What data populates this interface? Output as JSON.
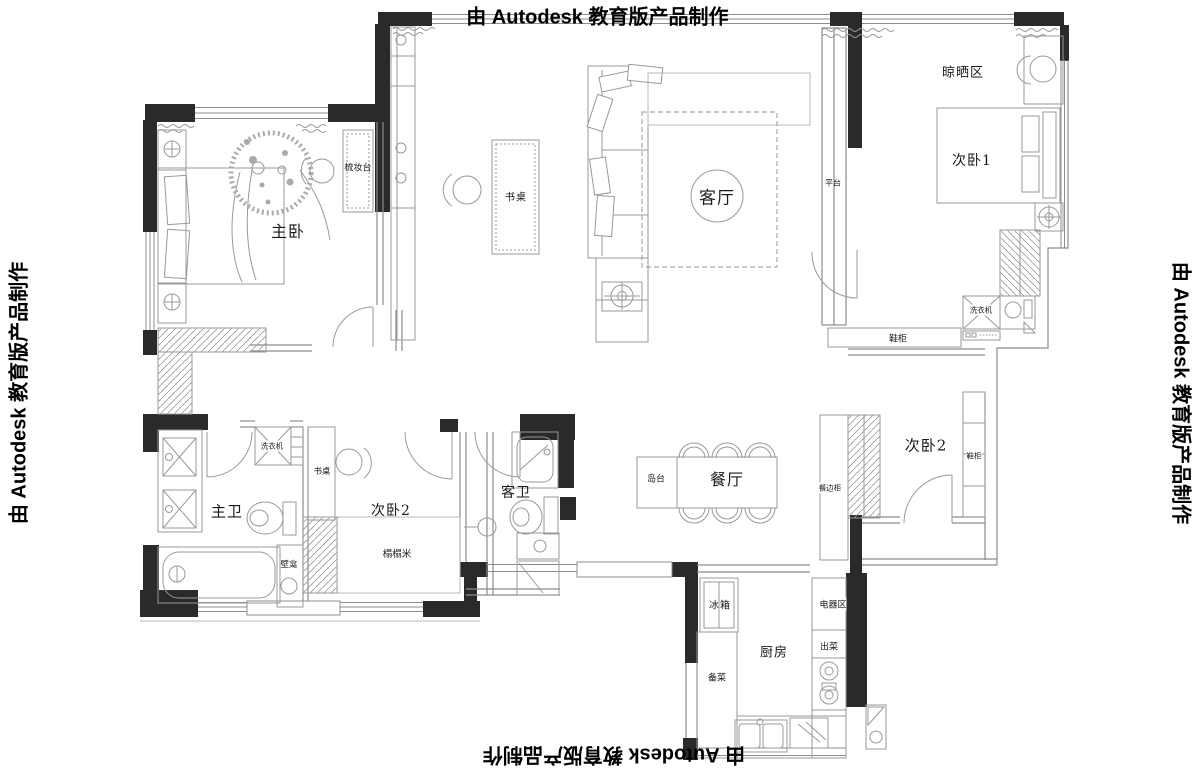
{
  "banner": {
    "text": "由 Autodesk 教育版产品制作"
  },
  "labels": {
    "master_bedroom": "主卧",
    "dressing_table": "梳妆台",
    "desk_living": "书桌",
    "living_room": "客厅",
    "platform": "平台",
    "drying_area": "晾晒区",
    "bedroom1": "次卧1",
    "washer_right": "洗衣机",
    "shoe_cabinet_top": "鞋柜",
    "bedroom2_right": "次卧2",
    "shoe_cabinet_right": "鞋柜",
    "sideboard": "餐边柜",
    "dining_room": "餐厅",
    "island": "岛台",
    "master_bath": "主卫",
    "washer_left": "洗衣机",
    "desk_bedroom": "书桌",
    "bedroom2_left": "次卧2",
    "tatami": "榻榻米",
    "niche": "壁龛",
    "guest_bath": "客卫",
    "fridge": "冰箱",
    "appliance_area": "电器区",
    "serving": "出菜",
    "kitchen": "厨房",
    "prep": "备菜"
  },
  "colors": {
    "wall": "#2a2a2a",
    "line_medium": "#8c8c8c",
    "line_light": "#b9b9b9",
    "text": "#1a1a1a",
    "background": "#ffffff"
  }
}
